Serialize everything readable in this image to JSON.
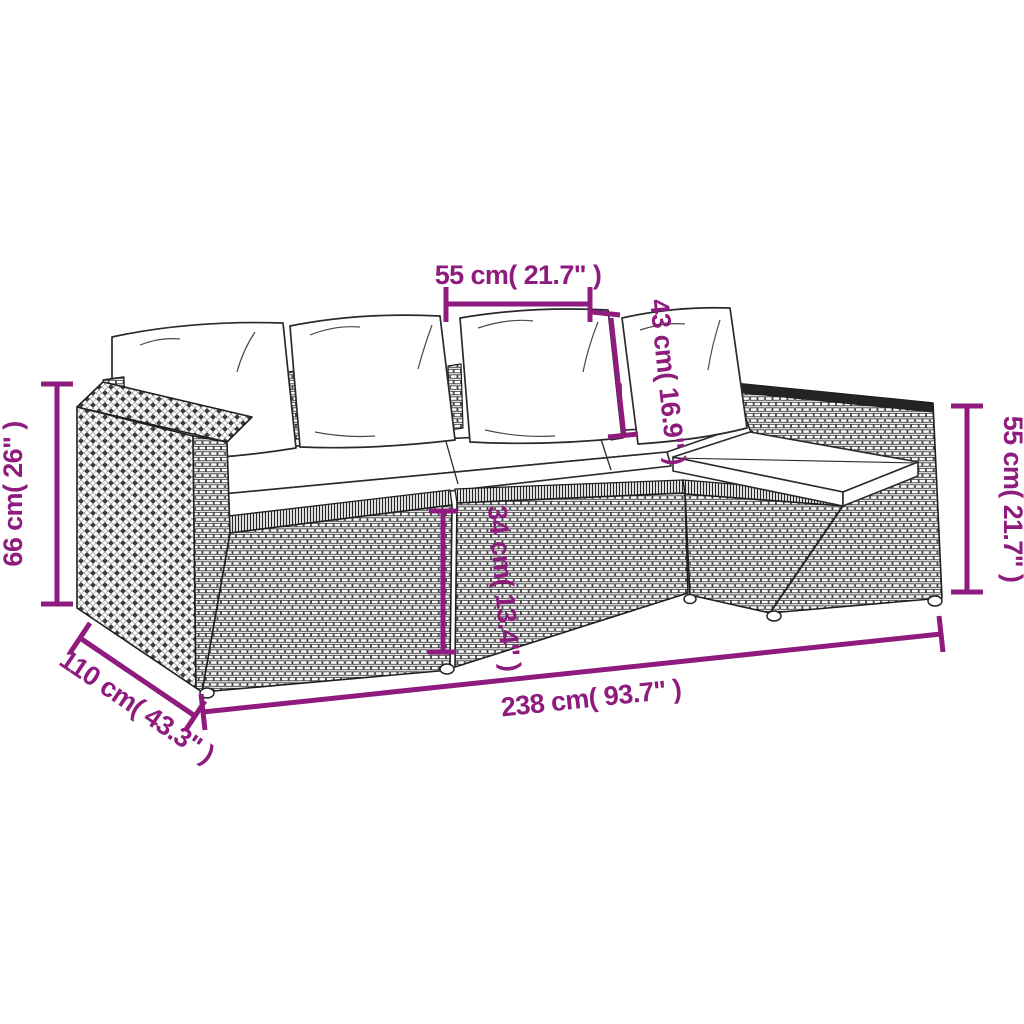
{
  "diagram": {
    "type": "product-dimension-diagram",
    "subject": "poly rattan garden lounge sofa set with cushions",
    "accent_color": "#8E1B7D",
    "line_color": "#1f1f1f",
    "background_color": "#ffffff",
    "dimensions": {
      "seat_width": {
        "cm": 55,
        "inches": 21.7,
        "label": "55 cm( 21.7\" )"
      },
      "back_height": {
        "cm": 43,
        "inches": 16.9,
        "label": "43 cm( 16.9\" )"
      },
      "armrest_height": {
        "cm": 66,
        "inches": 26,
        "label": "66 cm( 26\" )"
      },
      "side_height": {
        "cm": 55,
        "inches": 21.7,
        "label": "55 cm( 21.7\" )"
      },
      "seat_height": {
        "cm": 34,
        "inches": 13.4,
        "label": "34 cm( 13.4\" )"
      },
      "total_length": {
        "cm": 238,
        "inches": 93.7,
        "label": "238 cm( 93.7\" )"
      },
      "total_depth": {
        "cm": 110,
        "inches": 43.3,
        "label": "110 cm( 43.3\" )"
      }
    }
  }
}
